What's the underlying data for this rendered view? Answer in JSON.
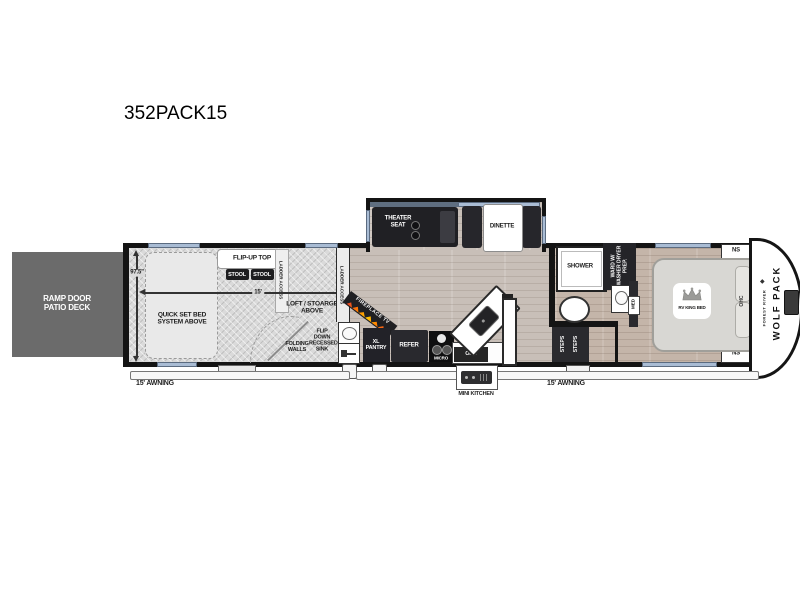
{
  "title": "352PACK15",
  "brand": {
    "name": "WOLF PACK",
    "maker": "FOREST RIVER"
  },
  "exterior": {
    "ramp_deck": "RAMP DOOR PATIO DECK",
    "awning_left": "15' AWNING",
    "awning_right": "15' AWNING",
    "mini_kitchen": "MINI KITCHEN"
  },
  "garage": {
    "quick_bed": "QUICK SET BED SYSTEM ABOVE",
    "flip_up_top": "FLIP-UP TOP",
    "stool_1": "STOOL",
    "stool_2": "STOOL",
    "ladder_access_1": "LADDER ACCESS",
    "ladder_access_2": "LADDER ACCESS",
    "loft_storage": "LOFT / STOARGE ABOVE",
    "folding_walls": "FOLDING WALLS",
    "flip_down_sink": "FLIP DOWN RECESSED SINK",
    "dim_width": "97.5\"",
    "dim_length": "15'"
  },
  "living": {
    "theater_seat": "THEATER SEAT",
    "dinette": "DINETTE",
    "fireplace_tv": "FIREPLACE  TV",
    "xl_pantry": "XL PANTRY",
    "refrigerator": "REFER",
    "microwave": "MICRO",
    "ohc": "OHC"
  },
  "bath": {
    "shower": "SHOWER",
    "wardrobe": "WARD W/ WASHER DRYER PREP.",
    "medicine": "MED",
    "steps_1": "STEPS",
    "steps_2": "STEPS"
  },
  "bedroom": {
    "bed": "RV KING BED",
    "nightstand_top": "NS",
    "nightstand_bottom": "NS",
    "ohc": "OHC"
  },
  "colors": {
    "wall": "#141414",
    "window": "#a9bcd4",
    "deck": "#6b6b6b",
    "garage_floor": "#dadada",
    "wood_living": "#c8bfb8",
    "wood_bedroom": "#c4b5a9",
    "dark_unit": "#26262b",
    "flame_orange": "#ff7a00"
  }
}
